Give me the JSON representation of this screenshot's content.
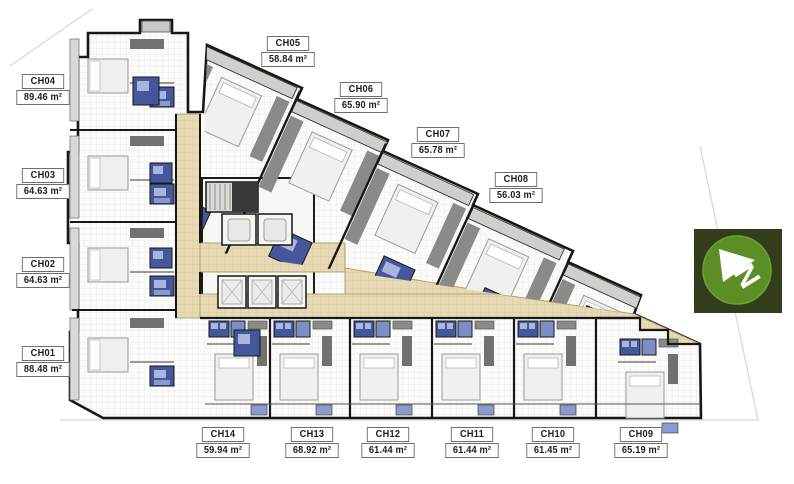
{
  "units": [
    {
      "id": "CH01",
      "area": "88.48 m²"
    },
    {
      "id": "CH02",
      "area": "64.63 m²"
    },
    {
      "id": "CH03",
      "area": "64.63 m²"
    },
    {
      "id": "CH04",
      "area": "89.46 m²"
    },
    {
      "id": "CH05",
      "area": "58.84 m²"
    },
    {
      "id": "CH06",
      "area": "65.90 m²"
    },
    {
      "id": "CH07",
      "area": "65.78 m²"
    },
    {
      "id": "CH08",
      "area": "56.03 m²"
    },
    {
      "id": "CH09",
      "area": "65.19 m²"
    },
    {
      "id": "CH10",
      "area": "61.45 m²"
    },
    {
      "id": "CH11",
      "area": "61.44 m²"
    },
    {
      "id": "CH12",
      "area": "61.44 m²"
    },
    {
      "id": "CH13",
      "area": "68.92 m²"
    },
    {
      "id": "CH14",
      "area": "59.94 m²"
    }
  ],
  "compass": {
    "letter": "N"
  },
  "colors": {
    "corridor": "#e7d9b3",
    "corridor_grid": "#d8c79c",
    "bathroom_dark": "#46569b",
    "bathroom_light": "#a9b5dc",
    "wall": "#171717",
    "compass_bg": "#333d1b",
    "compass_circle": "#5c8e27"
  }
}
